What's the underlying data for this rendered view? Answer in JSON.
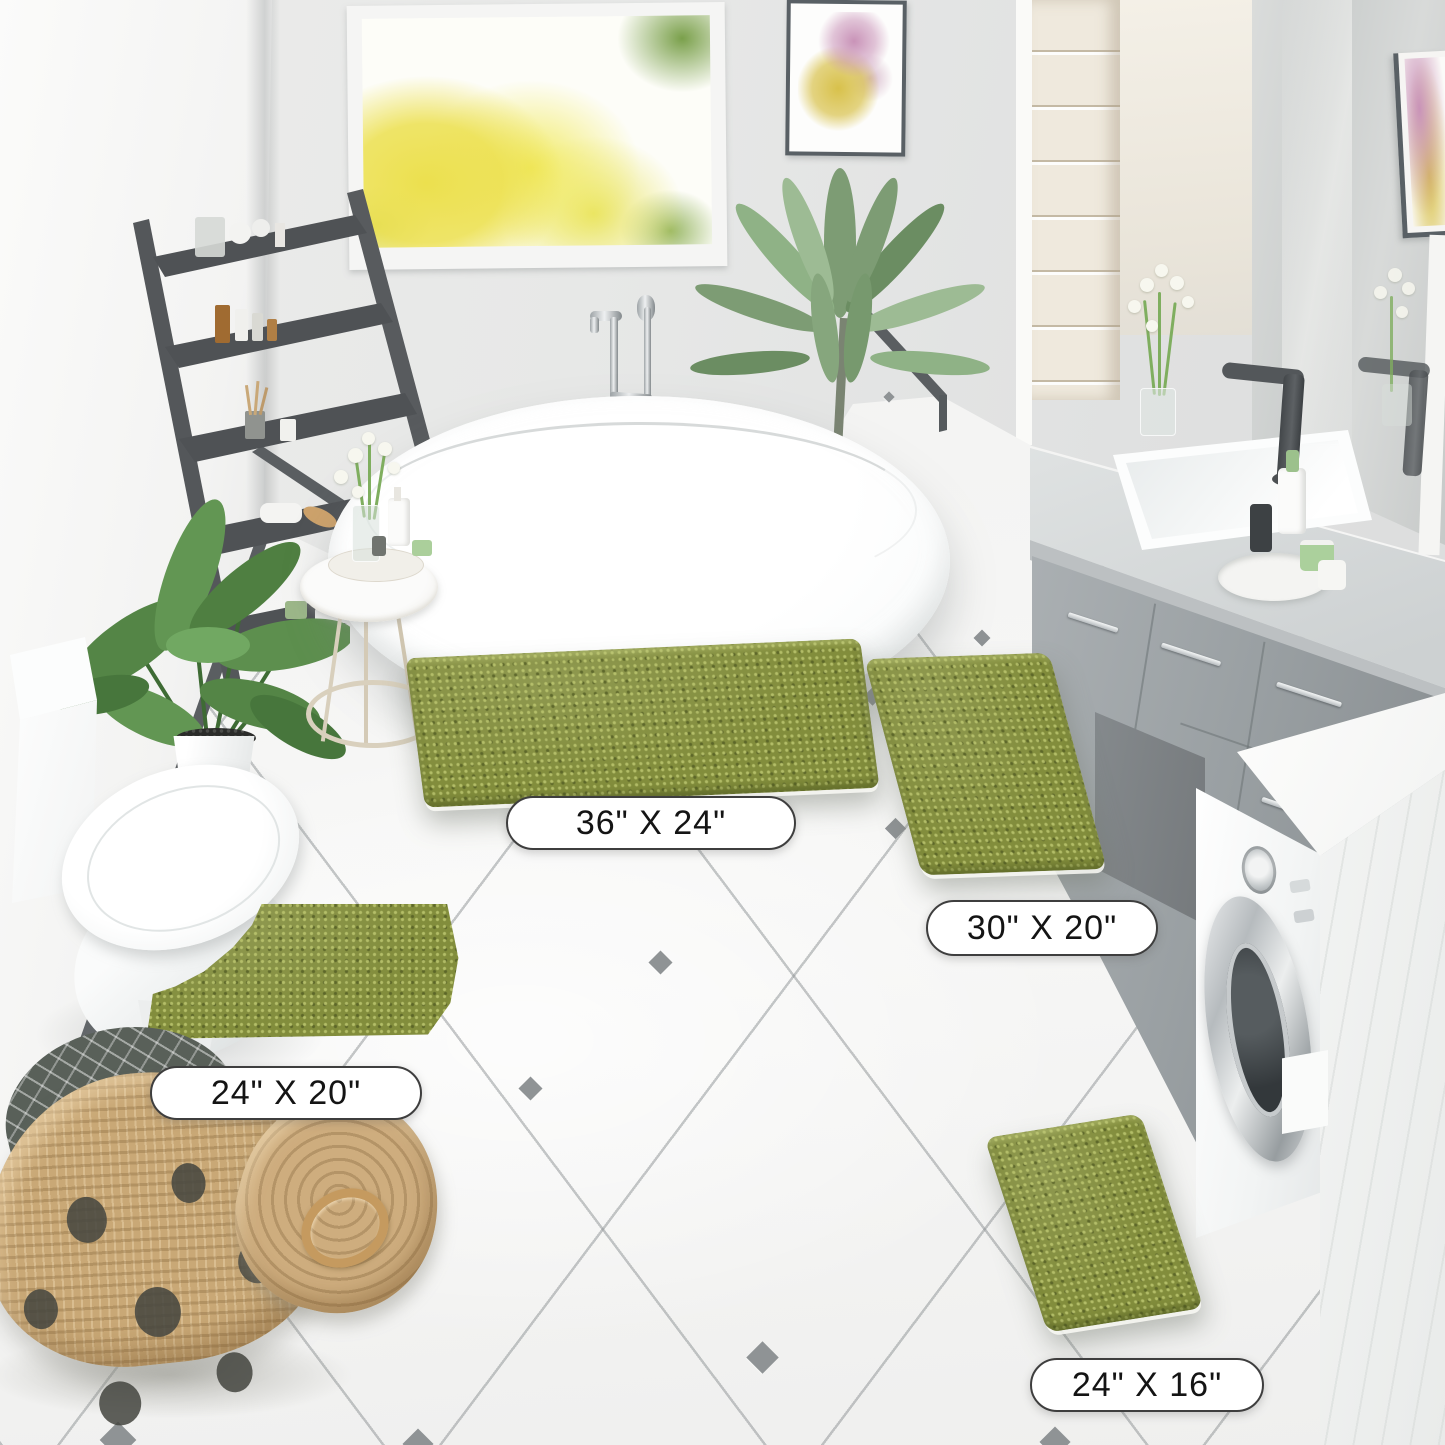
{
  "scene": {
    "description": "Bathroom product photo showing a four-piece olive-green chenille bath rug set laid on a white diagonal-tiled floor",
    "setting": "bathroom with freestanding tub, window, vanity with double sink, toilet, washing machine, plants, ladder shelf and wicker basket"
  },
  "labels": {
    "rug_large": "36\" X 24\"",
    "rug_runner": "30\" X 20\"",
    "rug_contour": "24\" X 20\"",
    "rug_small": "24\" X 16\""
  },
  "colors": {
    "rug_green": "#828d3c",
    "rug_green_light": "#bac46e",
    "rug_green_dark": "#505c22",
    "floor_white": "#f5f5f4",
    "grout_gray": "#969a9c",
    "tile_accent": "#8f9395",
    "wall_gray": "#e5e6e5",
    "left_wall": "#f3f3f2",
    "baseboard": "#5a5e61",
    "ladder_gray": "#54575a",
    "vanity_gray": "#9aa0a3",
    "counter_gray": "#d5d8d9",
    "cream_cabinet": "#efe9dd",
    "basket_tan": "#c9a876",
    "label_border": "#3e3e3e",
    "window_foliage_yellow": "#ece04e",
    "window_foliage_green": "#7aa04b",
    "art_pink": "#c993b8",
    "art_yellow": "#d8c14b"
  },
  "objects": [
    "window-with-autumn-trees",
    "wall-art",
    "wall-art-2",
    "ladder-shelf",
    "banana-plant",
    "palm-plant",
    "freestanding-bathtub",
    "tub-faucet",
    "side-table",
    "toilet",
    "contour-rug",
    "large-rug",
    "runner-rug",
    "small-rug",
    "vanity-counter",
    "vanity-sink",
    "vanity-faucet",
    "mirror",
    "flower-vase",
    "washing-machine",
    "white-cabinet",
    "wicker-basket",
    "tile-floor"
  ]
}
